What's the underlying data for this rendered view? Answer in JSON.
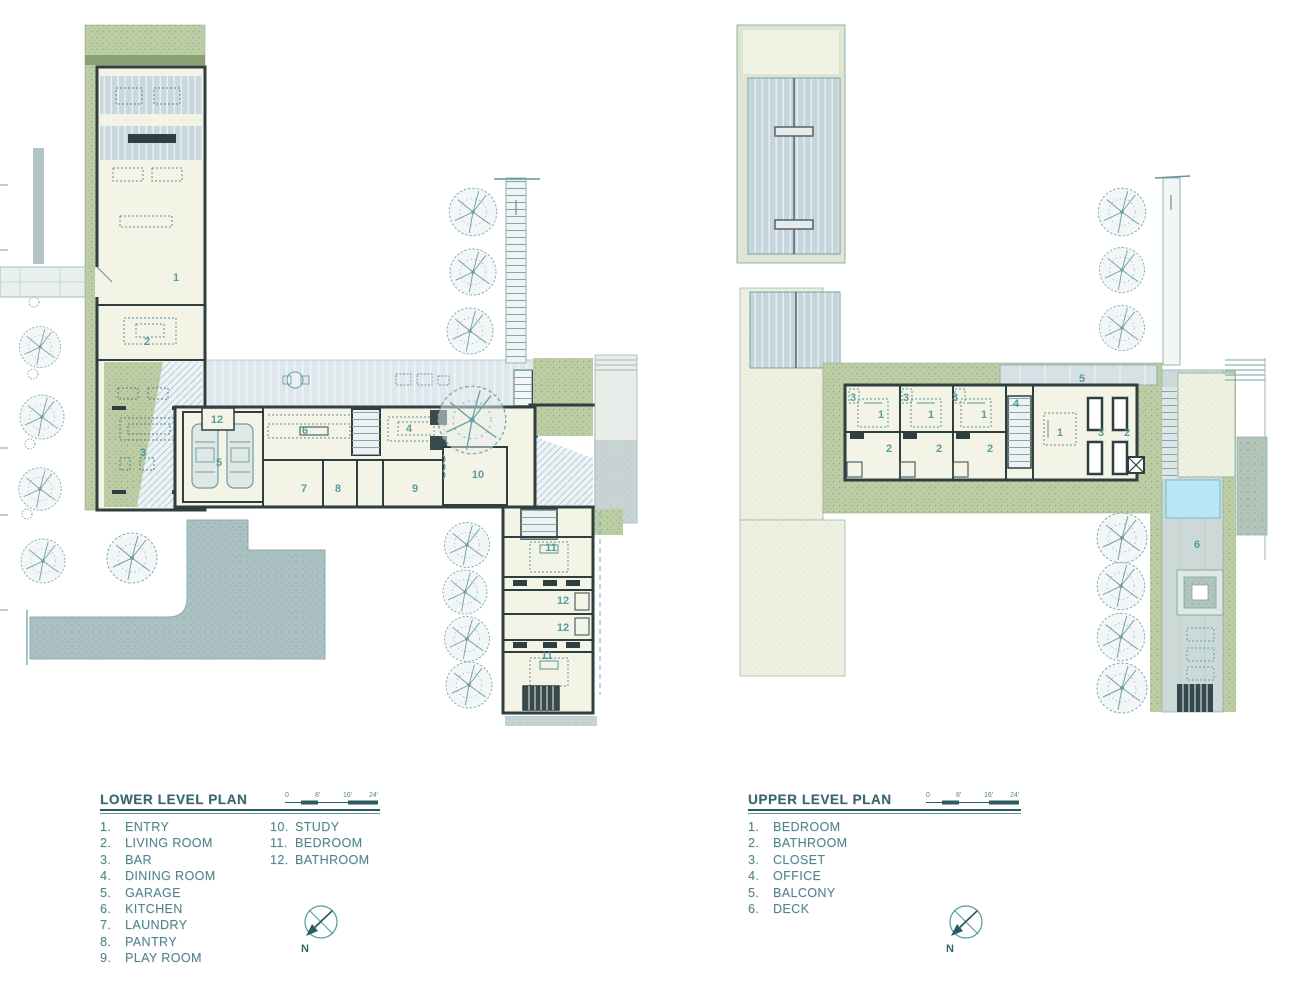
{
  "lower_plan": {
    "title": "LOWER LEVEL PLAN",
    "legend_left": [
      {
        "num": "1.",
        "label": "ENTRY"
      },
      {
        "num": "2.",
        "label": "LIVING ROOM"
      },
      {
        "num": "3.",
        "label": "BAR"
      },
      {
        "num": "4.",
        "label": "DINING ROOM"
      },
      {
        "num": "5.",
        "label": "GARAGE"
      },
      {
        "num": "6.",
        "label": "KITCHEN"
      },
      {
        "num": "7.",
        "label": "LAUNDRY"
      },
      {
        "num": "8.",
        "label": "PANTRY"
      },
      {
        "num": "9.",
        "label": "PLAY ROOM"
      }
    ],
    "legend_right": [
      {
        "num": "10.",
        "label": "STUDY"
      },
      {
        "num": "11.",
        "label": "BEDROOM"
      },
      {
        "num": "12.",
        "label": "BATHROOM"
      }
    ],
    "scale_bar": {
      "labels": [
        "0",
        "8'",
        "16'",
        "24'"
      ]
    },
    "north_label": "N",
    "room_labels": [
      "1",
      "2",
      "3",
      "12",
      "5",
      "6",
      "4",
      "7",
      "8",
      "9",
      "10",
      "11",
      "12",
      "12",
      "11"
    ]
  },
  "upper_plan": {
    "title": "UPPER LEVEL PLAN",
    "legend_left": [
      {
        "num": "1.",
        "label": "BEDROOM"
      },
      {
        "num": "2.",
        "label": "BATHROOM"
      },
      {
        "num": "3.",
        "label": "CLOSET"
      },
      {
        "num": "4.",
        "label": "OFFICE"
      },
      {
        "num": "5.",
        "label": "BALCONY"
      },
      {
        "num": "6.",
        "label": "DECK"
      }
    ],
    "scale_bar": {
      "labels": [
        "0",
        "8'",
        "16'",
        "24'"
      ]
    },
    "north_label": "N",
    "room_labels": [
      "3",
      "1",
      "2",
      "3",
      "1",
      "2",
      "3",
      "1",
      "2",
      "4",
      "5",
      "1",
      "3",
      "2",
      "6"
    ]
  },
  "palette": {
    "legend_text": "#4e868e",
    "title_text": "#35666e",
    "plan_line_teal": "#4d9aa0",
    "wall_dark": "#2f3e3e",
    "landscape_green": "#bccda5",
    "roof_hatch_blue": "#c9d8df",
    "paving_gray": "#abc0c0",
    "pool_blue": "#b9e6f5",
    "interior_cream": "#f4f4e6"
  }
}
